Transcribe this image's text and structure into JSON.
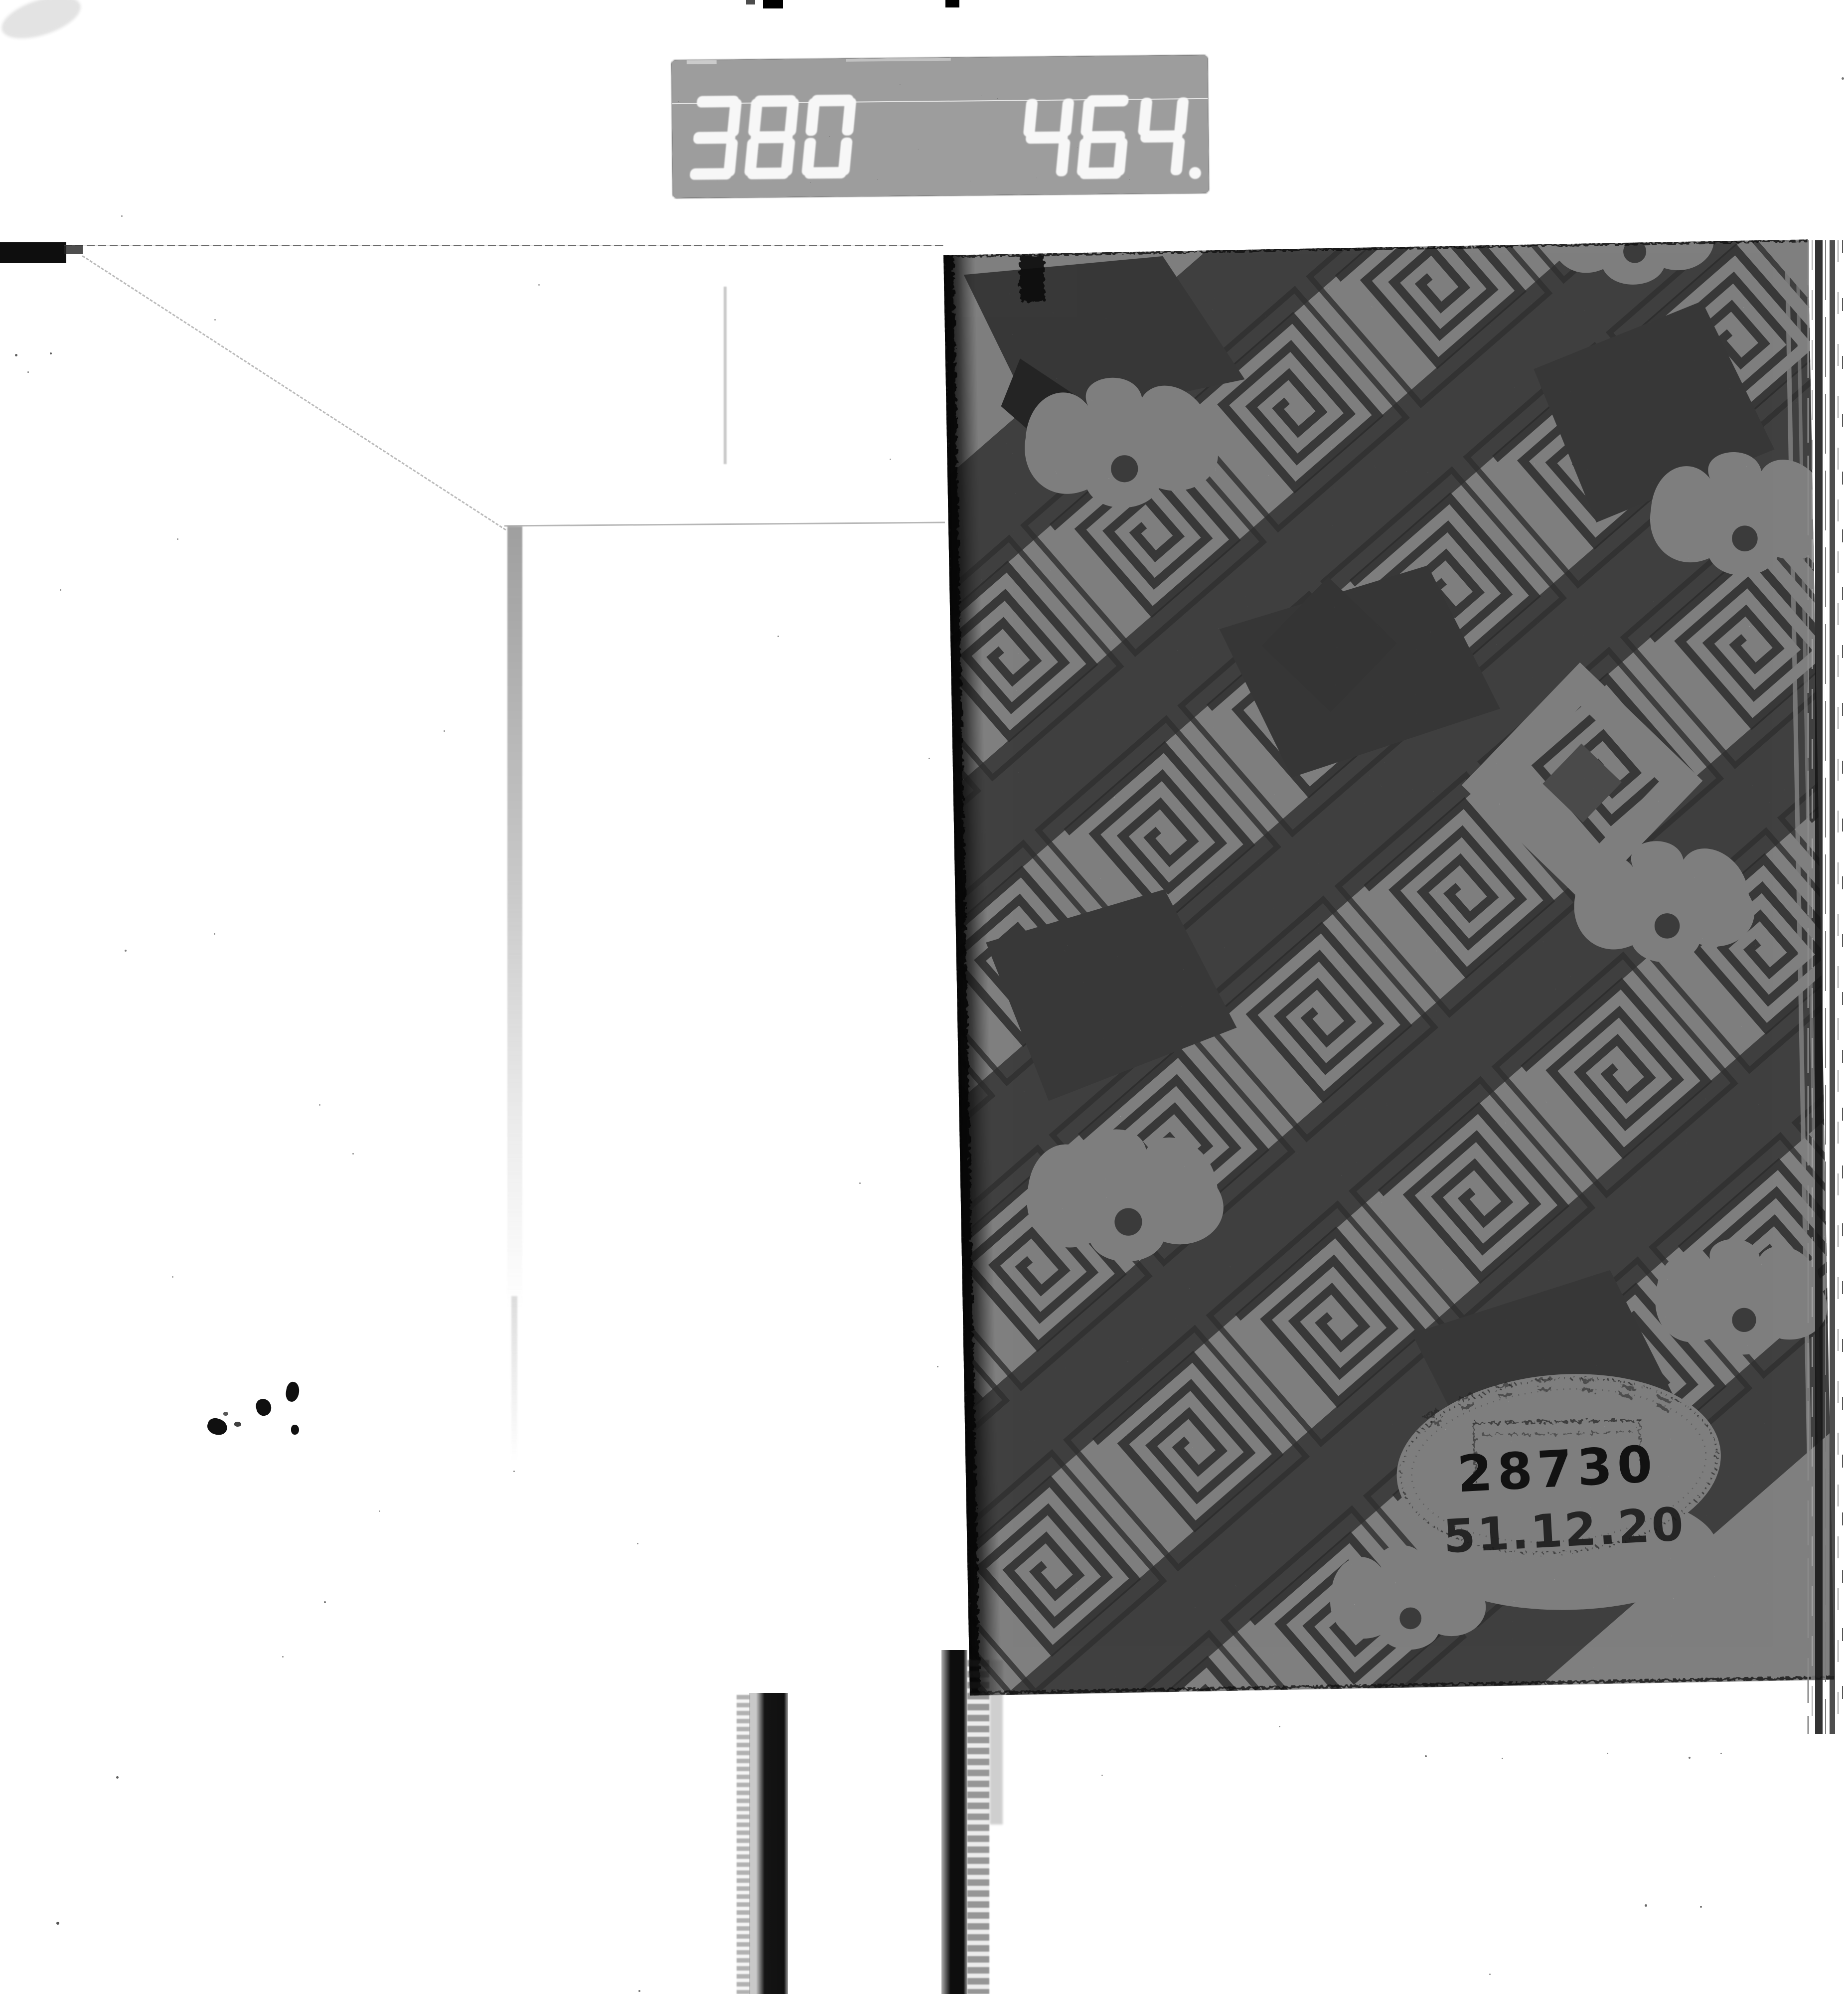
{
  "film_strip": {
    "frame_counter": {
      "left_value": "380",
      "right_value": "464",
      "decimal_point": true
    }
  },
  "book_cover": {
    "stamp": {
      "accession_number": "28730",
      "date_stamp": "51.12.20"
    }
  },
  "colors": {
    "page_background": "#ffffff",
    "counter_background": "#0b0b0b",
    "counter_digit": "#ececec",
    "pattern_gray": "#787878",
    "stamp_ink": "#2e2e2e"
  }
}
